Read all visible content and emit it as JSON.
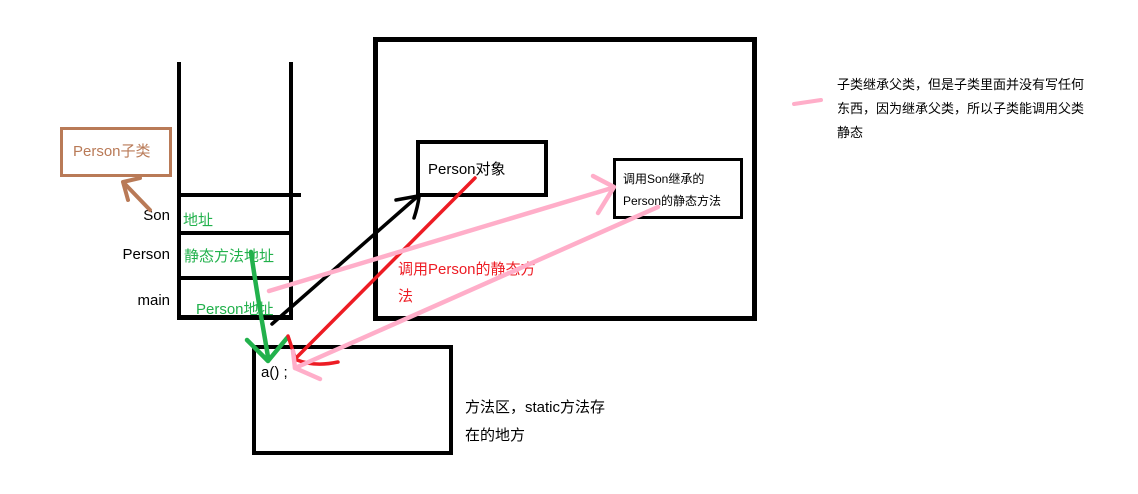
{
  "colors": {
    "black": "#000000",
    "brown": "#b97a57",
    "green": "#22b14c",
    "red": "#ed1c24",
    "pink": "#ffaec9"
  },
  "subclass_box": {
    "label": "Person子类"
  },
  "stack": {
    "rows": [
      {
        "label": "Son",
        "value": "地址"
      },
      {
        "label": "Person",
        "value": "静态方法地址"
      },
      {
        "label": "main",
        "value": "Person地址"
      }
    ]
  },
  "heap": {
    "person_object": {
      "label": "Person对象"
    },
    "son_static_call": {
      "line1": "调用Son继承的",
      "line2": "Person的静态方法"
    }
  },
  "red_annotation": {
    "line1": "调用Person的静态方",
    "line2": "法"
  },
  "method_area": {
    "statement": "a() ;",
    "caption_line1": "方法区，static方法存",
    "caption_line2": "在的地方"
  },
  "side_note": {
    "line1": "子类继承父类，但是子类里面并没有写任何",
    "line2": "东西，因为继承父类，所以子类能调用父类",
    "line3": "静态"
  }
}
